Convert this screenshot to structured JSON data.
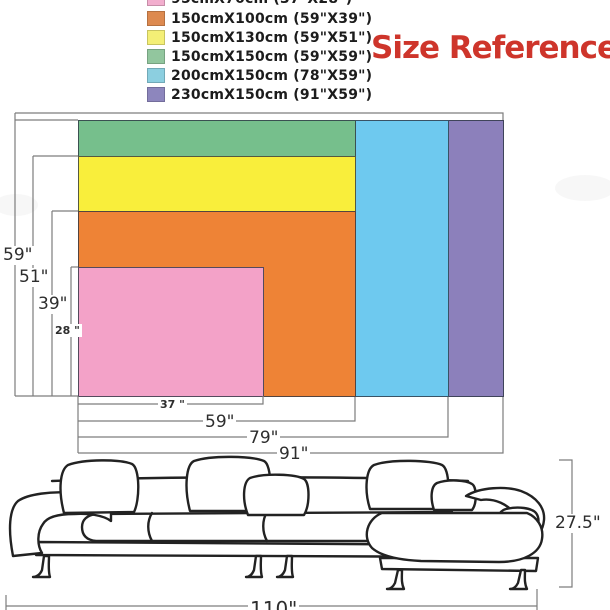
{
  "title": {
    "text": "Size Reference",
    "color": "#CE352B"
  },
  "legend": {
    "items": [
      {
        "label": "95cmX70cm (37\"X28\")",
        "swatch_color": "#F2AECE",
        "clipped": true
      },
      {
        "label": "150cmX100cm (59\"X39\")",
        "swatch_color": "#DD8A50",
        "clipped": false
      },
      {
        "label": "150cmX130cm (59\"X51\")",
        "swatch_color": "#F4EF76",
        "clipped": false
      },
      {
        "label": "150cmX150cm (59\"X59\")",
        "swatch_color": "#92C69E",
        "clipped": false
      },
      {
        "label": "200cmX150cm (78\"X59\")",
        "swatch_color": "#8CCFE0",
        "clipped": false
      },
      {
        "label": "230cmX150cm (91\"X59\")",
        "swatch_color": "#8D86BD",
        "clipped": false
      }
    ]
  },
  "chart_data": {
    "type": "table",
    "title": "Size Reference",
    "description": "Nested rectangles comparing sofa-cover sizes; all share bottom-left corner",
    "columns": [
      "size_cm",
      "size_inches",
      "width_in",
      "height_in",
      "color"
    ],
    "rows": [
      {
        "size_cm": "95cmX70cm",
        "size_inches": "37\"X28\"",
        "width_in": 37,
        "height_in": 28,
        "color": "#F3A2C8"
      },
      {
        "size_cm": "150cmX100cm",
        "size_inches": "59\"X39\"",
        "width_in": 59,
        "height_in": 39,
        "color": "#EE8336"
      },
      {
        "size_cm": "150cmX130cm",
        "size_inches": "59\"X51\"",
        "width_in": 59,
        "height_in": 51,
        "color": "#F9EE3B"
      },
      {
        "size_cm": "150cmX150cm",
        "size_inches": "59\"X59\"",
        "width_in": 59,
        "height_in": 59,
        "color": "#76BF8C"
      },
      {
        "size_cm": "200cmX150cm",
        "size_inches": "78\"X59\"",
        "width_in": 78,
        "height_in": 59,
        "color": "#6EC9EF"
      },
      {
        "size_cm": "230cmX150cm",
        "size_inches": "91\"X59\"",
        "width_in": 91,
        "height_in": 59,
        "color": "#8C80BB"
      }
    ]
  },
  "dimension_labels": {
    "height_59": "59\"",
    "height_51": "51\"",
    "height_39": "39\"",
    "height_28": "28 \"",
    "width_37": "37 \"",
    "width_59": "59\"",
    "width_79": "79\"",
    "width_91": "91\"",
    "sofa_height": "27.5\"",
    "sofa_width": "110\""
  }
}
